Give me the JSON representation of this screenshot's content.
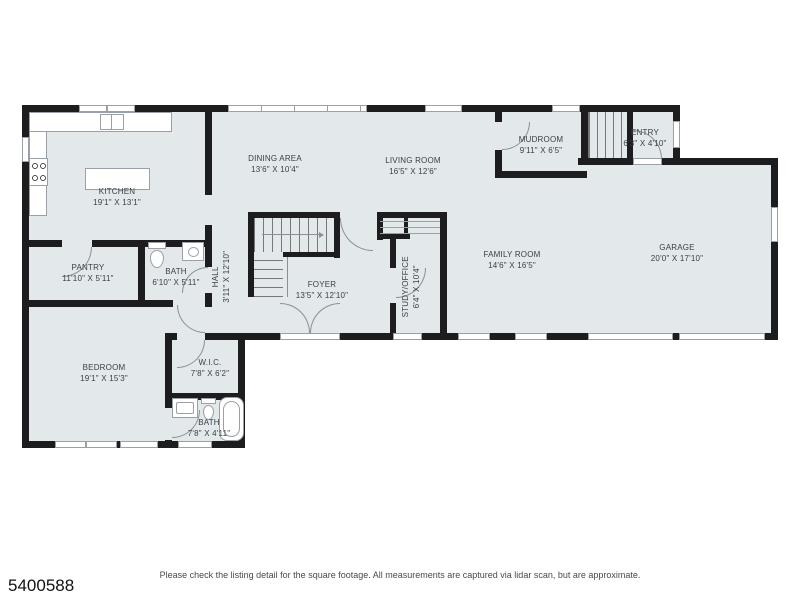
{
  "meta": {
    "listing_number": "5400588",
    "disclaimer": "Please check the listing detail for the square footage. All measurements are captured via lidar scan, but are approximate."
  },
  "colors": {
    "wall": "#1d1d1f",
    "room_fill": "#e3e8ea",
    "window_border": "#9aa0a8",
    "label_text": "#3b4046",
    "footer_text": "#4a4a4a",
    "background": "#ffffff"
  },
  "rooms": {
    "kitchen": {
      "name": "KITCHEN",
      "dims": "19'1\" X 13'1\""
    },
    "dining": {
      "name": "DINING AREA",
      "dims": "13'6\" X 10'4\""
    },
    "living": {
      "name": "LIVING ROOM",
      "dims": "16'5\" X 12'6\""
    },
    "mudroom": {
      "name": "MUDROOM",
      "dims": "9'11\" X 6'5\""
    },
    "entry": {
      "name": "ENTRY",
      "dims": "6'3\" X 4'10\""
    },
    "garage": {
      "name": "GARAGE",
      "dims": "20'0\" X 17'10\""
    },
    "family": {
      "name": "FAMILY ROOM",
      "dims": "14'6\" X 16'5\""
    },
    "pantry": {
      "name": "PANTRY",
      "dims": "11'10\" X 5'11\""
    },
    "bath1": {
      "name": "BATH",
      "dims": "6'10\" X 5'11\""
    },
    "hall": {
      "name": "HALL",
      "dims": "3'11\" X 12'10\""
    },
    "foyer": {
      "name": "FOYER",
      "dims": "13'5\" X 12'10\""
    },
    "study": {
      "name": "STUDY/OFFICE",
      "dims": "6'4\" X 10'4\""
    },
    "bedroom": {
      "name": "BEDROOM",
      "dims": "19'1\" X 15'3\""
    },
    "wic": {
      "name": "W.I.C.",
      "dims": "7'8\" X 6'2\""
    },
    "bath2": {
      "name": "BATH",
      "dims": "7'8\" X 4'11\""
    }
  },
  "fixtures": [
    "stove-icon",
    "kitchen-sink-icon",
    "kitchen-island",
    "toilet-icon",
    "bathroom-sink-icon",
    "bathtub-icon",
    "stairs-icon",
    "closet-shelves",
    "door-swing-icon",
    "window"
  ]
}
